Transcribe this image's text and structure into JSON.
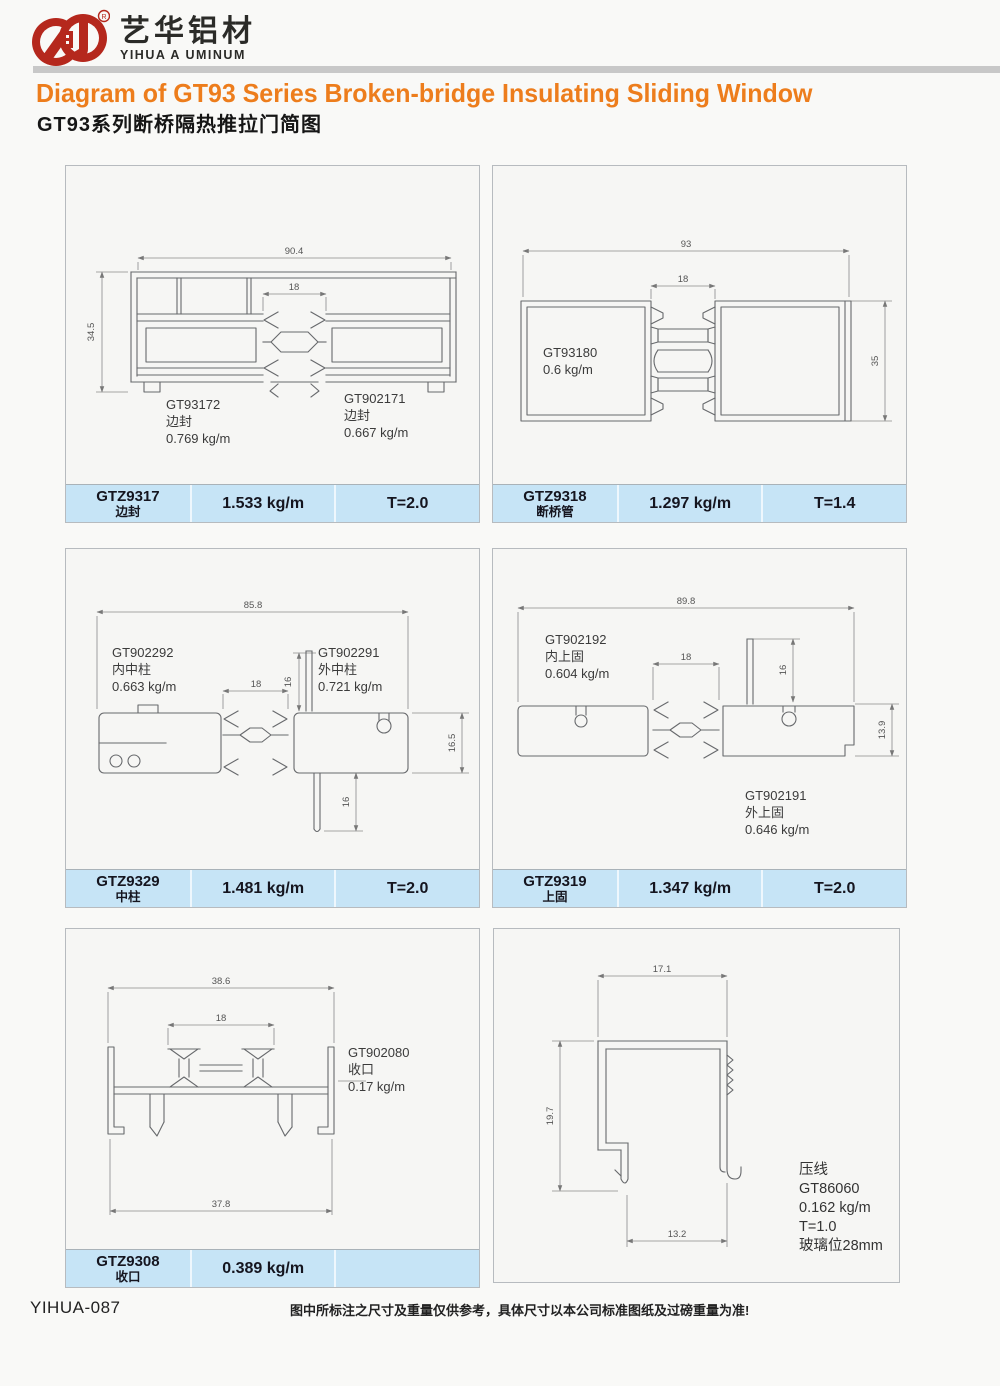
{
  "header": {
    "logo_cn": "艺华铝材",
    "logo_en": "YIHUA A UMINUM",
    "reg_mark": "R",
    "title_en": "Diagram of GT93 Series Broken-bridge Insulating Sliding Window",
    "title_cn": "GT93系列断桥隔热推拉门简图"
  },
  "footer": {
    "code": "YIHUA-087",
    "disclaimer": "图中所标注之尺寸及重量仅供参考，具体尺寸以本公司标准图纸及过磅重量为准!"
  },
  "colors": {
    "accent_orange": "#ed7d1c",
    "brand_red": "#b5281d",
    "table_blue": "#c6e4f6",
    "line_gray": "#67696c"
  },
  "panels": [
    {
      "dims": {
        "total_width": "90.4",
        "groove": "18",
        "height": "34.5"
      },
      "parts": [
        {
          "code": "GT93172",
          "name": "边封",
          "weight": "0.769 kg/m"
        },
        {
          "code": "GT902171",
          "name": "边封",
          "weight": "0.667 kg/m"
        }
      ],
      "table": {
        "model": "GTZ9317",
        "name": "边封",
        "weight": "1.533 kg/m",
        "thickness": "T=2.0"
      }
    },
    {
      "dims": {
        "total_width": "93",
        "groove": "18",
        "height": "35"
      },
      "parts": [
        {
          "code": "GT93180",
          "weight": "0.6 kg/m"
        }
      ],
      "table": {
        "model": "GTZ9318",
        "name": "断桥管",
        "weight": "1.297 kg/m",
        "thickness": "T=1.4"
      }
    },
    {
      "dims": {
        "total_width": "85.8",
        "groove": "18",
        "fin_top": "16",
        "height": "16.5",
        "fin_bottom": "16"
      },
      "parts": [
        {
          "code": "GT902292",
          "name": "内中柱",
          "weight": "0.663 kg/m"
        },
        {
          "code": "GT902291",
          "name": "外中柱",
          "weight": "0.721 kg/m"
        }
      ],
      "table": {
        "model": "GTZ9329",
        "name": "中柱",
        "weight": "1.481 kg/m",
        "thickness": "T=2.0"
      }
    },
    {
      "dims": {
        "total_width": "89.8",
        "groove": "18",
        "fin": "16",
        "height": "13.9"
      },
      "parts": [
        {
          "code": "GT902192",
          "name": "内上固",
          "weight": "0.604 kg/m"
        },
        {
          "code": "GT902191",
          "name": "外上固",
          "weight": "0.646 kg/m"
        }
      ],
      "table": {
        "model": "GTZ9319",
        "name": "上固",
        "weight": "1.347 kg/m",
        "thickness": "T=2.0"
      }
    },
    {
      "dims": {
        "top_width": "38.6",
        "groove": "18",
        "bottom_width": "37.8"
      },
      "parts": [
        {
          "code": "GT902080",
          "name": "收口",
          "weight": "0.17 kg/m"
        }
      ],
      "table": {
        "model": "GTZ9308",
        "name": "收口",
        "weight": "0.389 kg/m",
        "thickness": ""
      }
    },
    {
      "dims": {
        "top_width": "17.1",
        "height": "19.7",
        "bottom_width": "13.2"
      },
      "parts": [
        {
          "name": "压线",
          "code": "GT86060",
          "weight": "0.162 kg/m",
          "thickness": "T=1.0",
          "glass": "玻璃位28mm"
        }
      ]
    }
  ]
}
